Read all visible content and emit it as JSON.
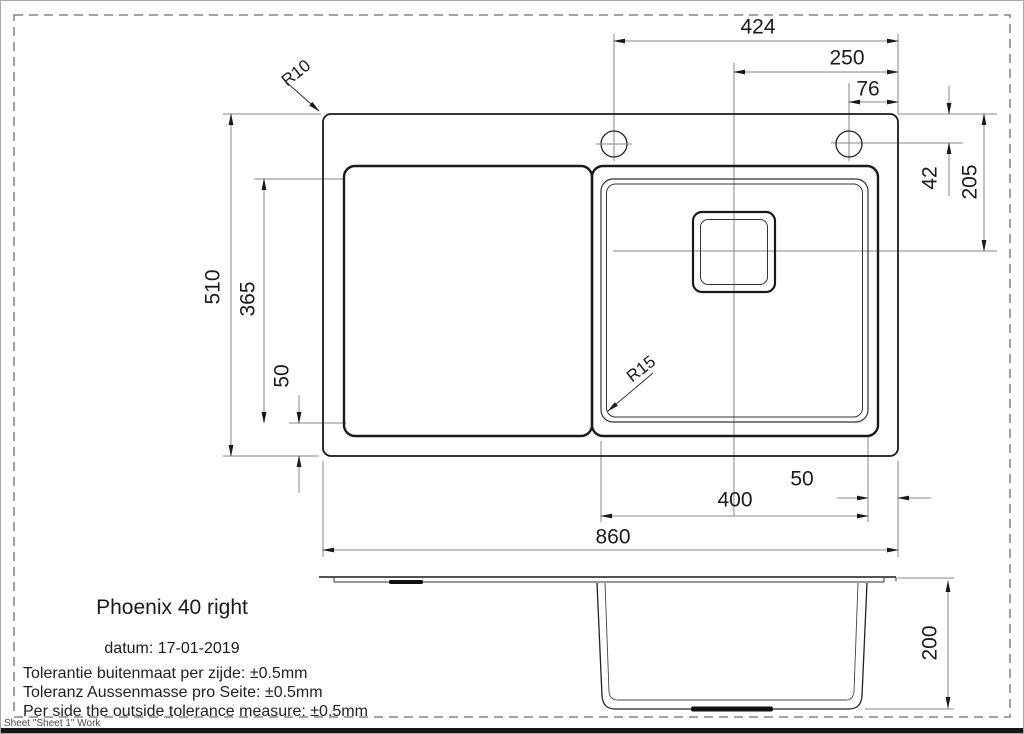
{
  "page": {
    "sheet_label": "Sheet \"Sheet 1\" Work"
  },
  "title_block": {
    "product_name": "Phoenix 40 right",
    "date_line": "datum: 17-01-2019",
    "tolerance_lines": [
      "Tolerantie buitenmaat per zijde: ±0.5mm",
      "Toleranz Aussenmasse pro Seite: ±0.5mm",
      "Per side the outside tolerance measure: ±0.5mm"
    ]
  },
  "dimensions_mm": {
    "hole_span": "424",
    "bowl_center_from_right": "250",
    "hole_from_right_edge": "76",
    "hole_center_from_top": "42",
    "bowl_center_from_top": "205",
    "overall_depth": "510",
    "bowl_length": "365",
    "bowl_bottom_offset": "50",
    "bowl_width": "400",
    "bowl_from_right_edge": "50",
    "overall_width": "860",
    "bowl_depth": "200",
    "outer_corner_radius": "R10",
    "bowl_corner_radius": "R15"
  },
  "colors": {
    "background": "#ffffff",
    "outline": "#1a1a1a",
    "dimension_lines": "#878787",
    "text": "#1a1a1a",
    "status_text": "#4a4a4a"
  }
}
